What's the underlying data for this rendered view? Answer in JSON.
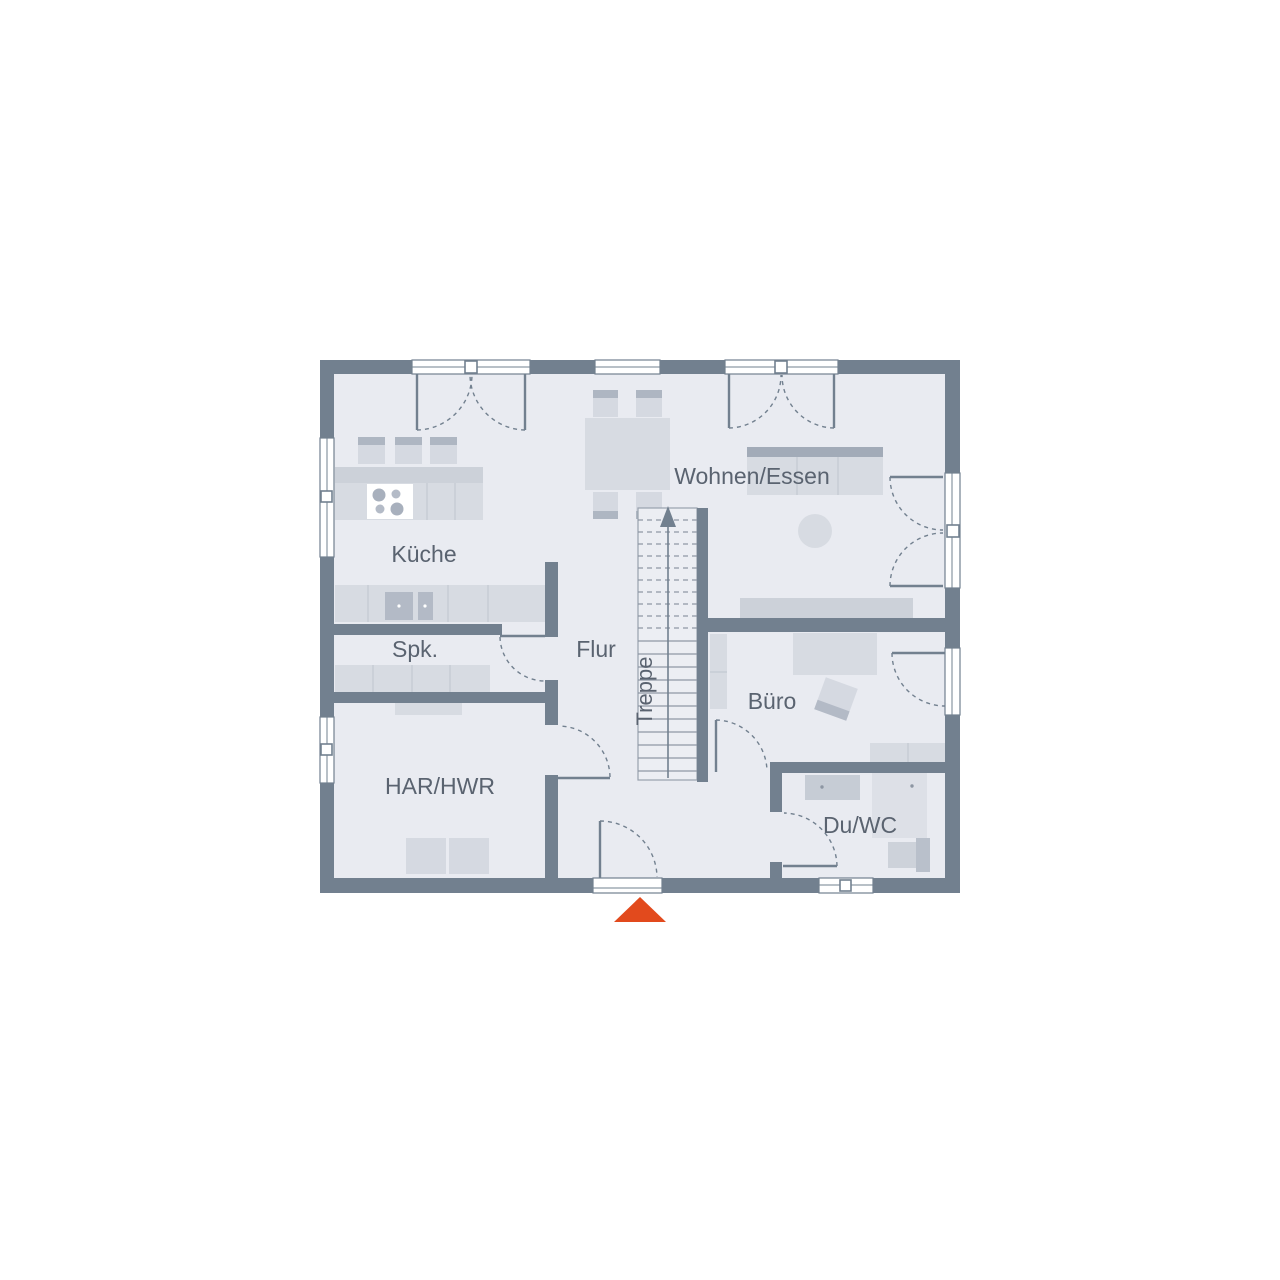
{
  "floorplan": {
    "title": "Erdgeschoss Grundriss",
    "rooms": {
      "kueche": "Küche",
      "spk": "Spk.",
      "flur": "Flur",
      "treppe": "Treppe",
      "har_hwr": "HAR/HWR",
      "wohnen_essen": "Wohnen/Essen",
      "buero": "Büro",
      "du_wc": "Du/WC"
    },
    "colors": {
      "wall": "#72808f",
      "floor": "#e9ebf1",
      "furniture_light": "#d7dbe2",
      "furniture_dark": "#aeb6c2",
      "label_text": "#5a6370",
      "entrance_marker": "#e24a1d"
    },
    "markers": {
      "entrance_triangle": "entrance-direction-triangle",
      "stair_direction": "up-arrow"
    }
  }
}
